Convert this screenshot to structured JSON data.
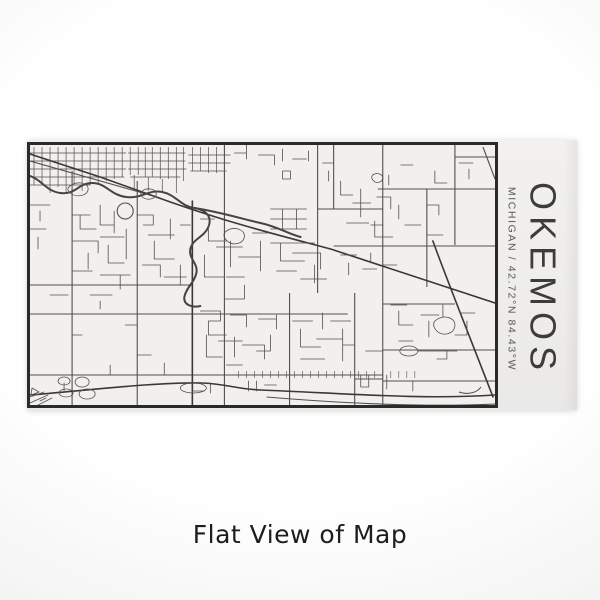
{
  "product": {
    "title": "OKEMOS",
    "subtitle": "MICHIGAN / 42.72°N 84.43°W",
    "caption": "Flat View of Map"
  },
  "map": {
    "name": "okemos-street-map-engraving",
    "city": "Okemos",
    "state": "Michigan",
    "coordinates": "42.72°N 84.43°W"
  },
  "colors": {
    "card_bg": "#f2f1ef",
    "map_bg": "#f1f0ee",
    "map_border": "#2b2a28",
    "street": "#51504c",
    "street_major": "#3a3936",
    "river": "#45443f",
    "title_text": "#3d3c3a",
    "subtitle_text": "#5a5956",
    "caption_text": "#1d1d1b"
  }
}
